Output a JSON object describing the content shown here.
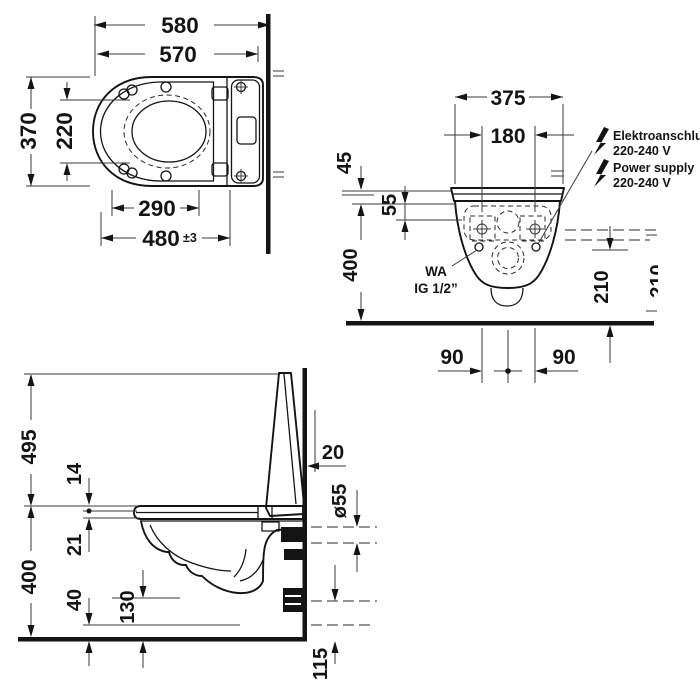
{
  "title": "Wall-hung shower toilet installation drawing, dimensions in mm",
  "colors": {
    "line": "#141414",
    "background": "#ffffff"
  },
  "views": {
    "plan": {
      "dims": {
        "overall_depth": "580",
        "ceramic_depth": "570",
        "width": "370",
        "bowl_width": "220",
        "bowl_length": "290",
        "fix_length": "480",
        "fix_tolerance": "±3"
      }
    },
    "front": {
      "dims": {
        "width": "375",
        "bolt_spacing": "180",
        "seat_stack": "45",
        "top_offset": "55",
        "rim_height": "400",
        "connection_height": "210",
        "bolt_left": "90",
        "bolt_right": "90",
        "edge_clipped_height": "210"
      },
      "labels": {
        "electrical_de": "Elektroanschluss",
        "electrical_volt": "220-240 V",
        "power_en": "Power supply",
        "power_volt": "220-240 V",
        "water_line1": "WA",
        "water_line2": "IG 1/2”"
      },
      "icons": {
        "lightning": "electrical-connection"
      }
    },
    "side": {
      "dims": {
        "open_lid_height": "495",
        "seat_gap": "14",
        "seat_thickness": "21",
        "rim_height": "400",
        "bottom_clearance": "40",
        "bowl_bottom_height": "130",
        "wall_clearance": "20",
        "outlet_diameter": "ø55",
        "outlet_height": "115"
      }
    }
  }
}
